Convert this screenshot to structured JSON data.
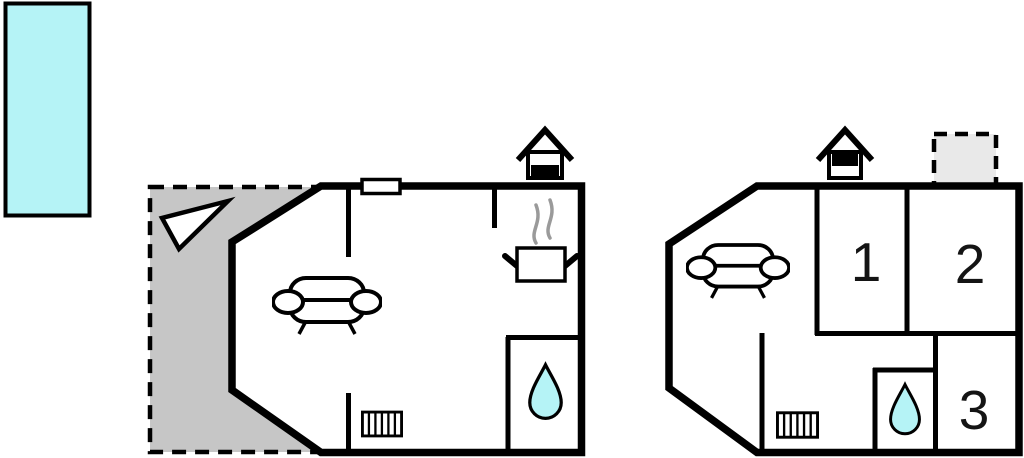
{
  "title": "Property floor plans",
  "colors": {
    "water": "#b5f3f6",
    "terrace": "#c6c6c6",
    "annex_fill": "#e9e9e9",
    "steam": "#9a9a9a",
    "wall": "#000000"
  },
  "pool": {
    "icon": "swimming-pool"
  },
  "left_plan": {
    "icons": [
      "terrace",
      "north-arrow",
      "window",
      "sofa",
      "steaming-pot",
      "water-drop",
      "radiator",
      "chimney"
    ]
  },
  "right_plan": {
    "room_labels": [
      "1",
      "2",
      "3"
    ],
    "icons": [
      "annex",
      "sofa",
      "water-drop",
      "radiator",
      "chimney"
    ]
  }
}
